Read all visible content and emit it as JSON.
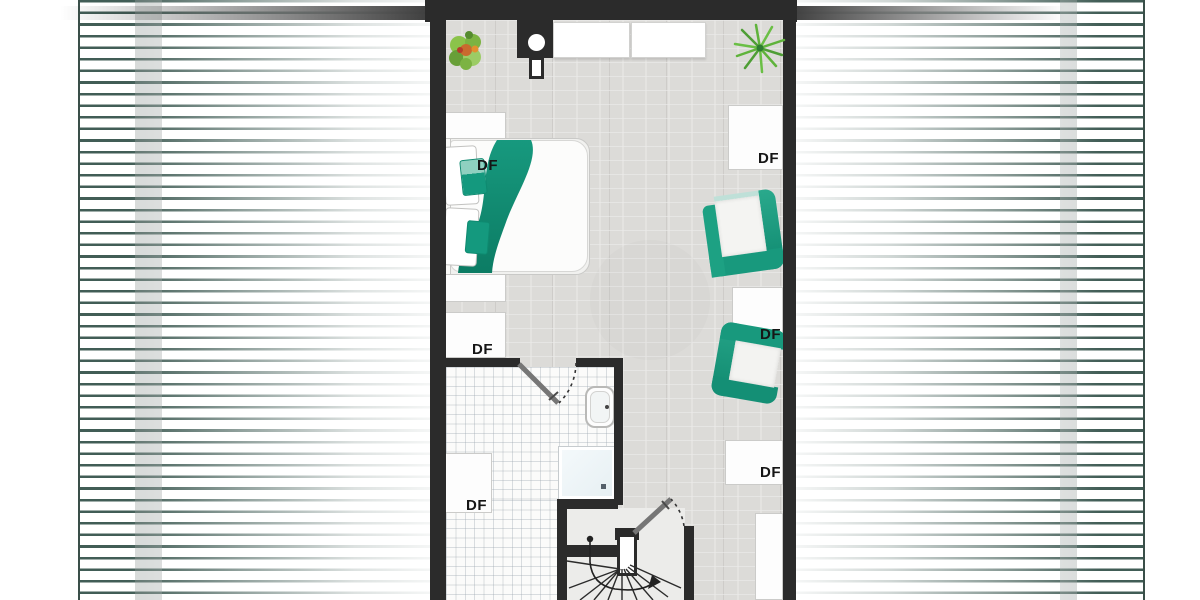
{
  "labels": {
    "roof_window": "DF"
  },
  "colors": {
    "accent_teal": "#17997e",
    "accent_teal_dark": "#0f8a70",
    "accent_teal_light": "#bfe0d8",
    "wall": "#2b2b2b",
    "roof_stripe": "#415d56",
    "floor_plank": "#dcdbd8",
    "tile_line": "#98a2ac",
    "plant_green": "#7cb342",
    "palm_green": "#5fb33b"
  },
  "elements": {
    "roof_window_labels": 6,
    "furniture": [
      "double-bed",
      "armchair-upper",
      "armchair-lower",
      "wardrobe-left",
      "wardrobe-right",
      "sink",
      "shower",
      "spiral-staircase",
      "potted-plant",
      "palm-plant",
      "chimney"
    ]
  }
}
